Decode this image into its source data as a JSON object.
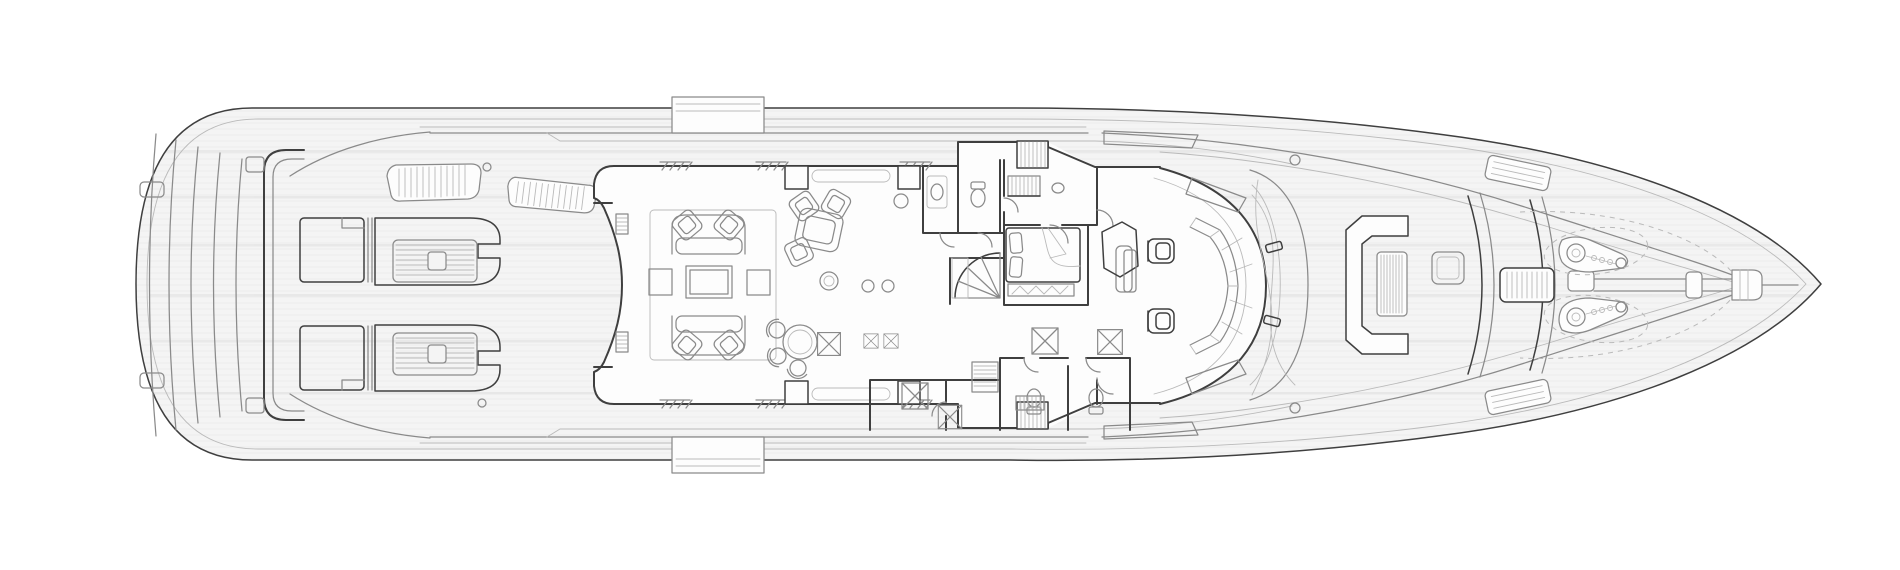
{
  "meta": {
    "artifact": "yacht-main-deck-floor-plan",
    "style": "technical-line-drawing",
    "orientation": "bow-right-stern-left",
    "aria_label": "Black and white architectural top-view deck plan of a motor yacht, bow pointing right"
  },
  "palette": {
    "background": "#ffffff",
    "deck-fill": "#f4f4f4",
    "interior-fill": "#fdfdfd",
    "line-strong": "#3f3f3f",
    "line-medium": "#8a8a8a",
    "line-light": "#bababa",
    "plank-stripe": "#e7e7e7",
    "streak": "#e0e0e0"
  },
  "features": {
    "stern": [
      "transom-steps",
      "swim-platform-bands",
      "stern-cleats",
      "aft-deck-bulwark"
    ],
    "aft_deck": [
      "port-sun-lounger",
      "starboard-sun-lounger",
      "lounger-mattress-hatch",
      "engine-vent-grille-aft",
      "engine-vent-grille-forward",
      "boarding-box-port",
      "boarding-box-starboard"
    ],
    "salon": [
      "curved-aft-bulkhead",
      "entry-step-hatches",
      "lounge-rug",
      "twin-sofas",
      "four-armchairs",
      "three-coffee-tables",
      "game-table-with-chairs",
      "planter-circles",
      "round-dining-table",
      "tub-chairs",
      "x-marked-side-tables",
      "sideboards",
      "window-sills",
      "door-frames"
    ],
    "midship": [
      "guest-lobby",
      "day-head-toilets",
      "vanity-counter",
      "upper-staircase",
      "inner-staircase",
      "spiral-staircase",
      "double-bed-cabin",
      "pillows",
      "bedspread-fold",
      "foot-bench-zigzag",
      "lower-corridor",
      "shower-x-boxes",
      "companionway-treads",
      "door-swing-arcs"
    ],
    "wheelhouse": [
      "curved-windshield",
      "faceted-helm-console",
      "two-helm-chairs",
      "settee-bench",
      "stair-fairing-hexagon",
      "wing-consoles",
      "mast-fairing-curves",
      "deck-fitting-circles"
    ],
    "foredeck": [
      "c-shaped-seat",
      "slatted-cocktail-table",
      "deck-hatch",
      "breakwater-bands",
      "chain-stopper",
      "anchor-chain-shaft",
      "port-windlass",
      "starboard-windlass",
      "chain-links",
      "dashed-locker-outlines",
      "angled-crew-benches",
      "bow-roller",
      "bow-tip"
    ]
  }
}
